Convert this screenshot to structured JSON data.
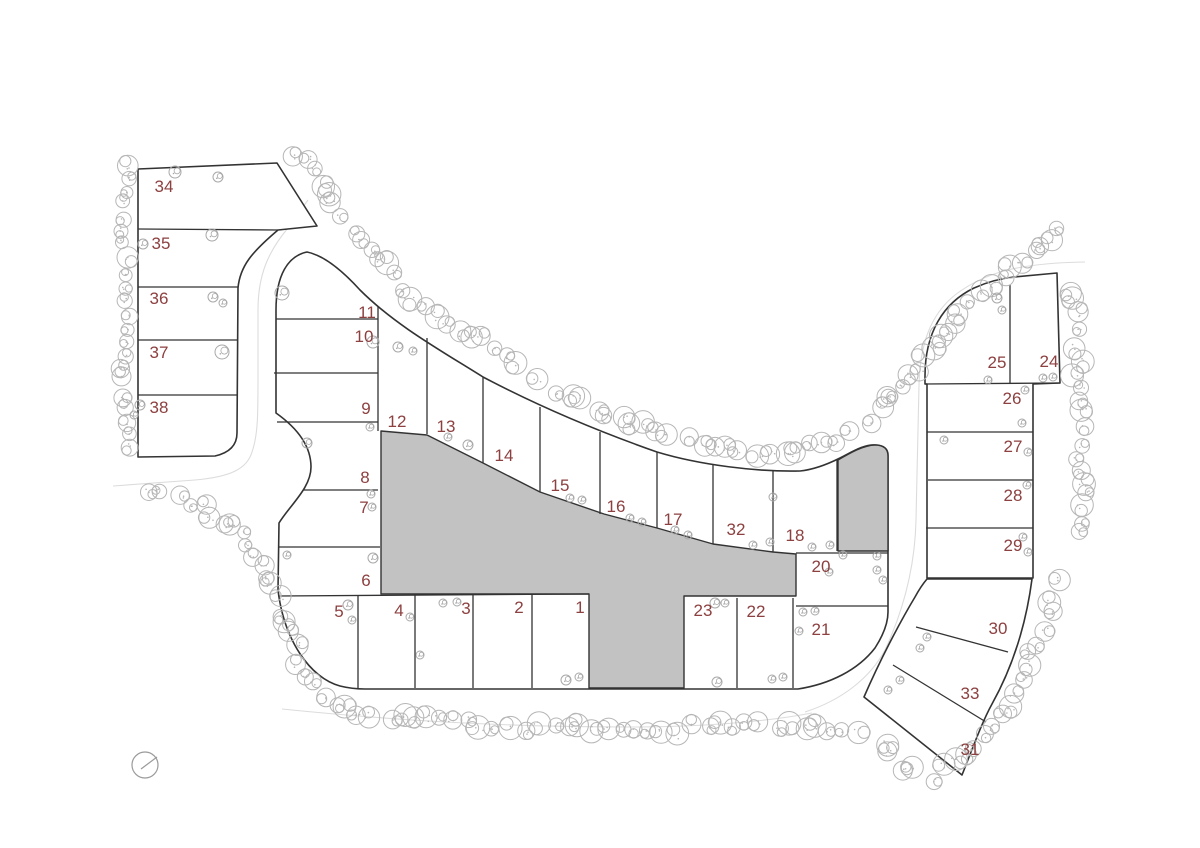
{
  "plan": {
    "title": "residential-subdivision-site-plan",
    "colors": {
      "lot_number": "#8d4040",
      "line": "#333333",
      "gray_parcel": "#c2c2c2",
      "tree": "#b6b6b6",
      "tree_small": "#a8a8a8",
      "faint_road": "#dcdcdc",
      "background": "#ffffff"
    },
    "lots": [
      {
        "number": "34",
        "x": 164,
        "y": 192
      },
      {
        "number": "35",
        "x": 161,
        "y": 249
      },
      {
        "number": "36",
        "x": 159,
        "y": 304
      },
      {
        "number": "37",
        "x": 159,
        "y": 358
      },
      {
        "number": "38",
        "x": 159,
        "y": 413
      },
      {
        "number": "11",
        "x": 367,
        "y": 318
      },
      {
        "number": "10",
        "x": 364,
        "y": 342
      },
      {
        "number": "9",
        "x": 366,
        "y": 414
      },
      {
        "number": "12",
        "x": 397,
        "y": 427
      },
      {
        "number": "13",
        "x": 446,
        "y": 432
      },
      {
        "number": "14",
        "x": 504,
        "y": 461
      },
      {
        "number": "15",
        "x": 560,
        "y": 491
      },
      {
        "number": "16",
        "x": 616,
        "y": 512
      },
      {
        "number": "17",
        "x": 673,
        "y": 525
      },
      {
        "number": "32",
        "x": 736,
        "y": 535
      },
      {
        "number": "18",
        "x": 795,
        "y": 541
      },
      {
        "number": "20",
        "x": 821,
        "y": 572
      },
      {
        "number": "8",
        "x": 365,
        "y": 483
      },
      {
        "number": "7",
        "x": 364,
        "y": 513
      },
      {
        "number": "6",
        "x": 366,
        "y": 586
      },
      {
        "number": "5",
        "x": 339,
        "y": 617
      },
      {
        "number": "4",
        "x": 399,
        "y": 616
      },
      {
        "number": "3",
        "x": 466,
        "y": 614
      },
      {
        "number": "2",
        "x": 519,
        "y": 613
      },
      {
        "number": "1",
        "x": 580,
        "y": 613
      },
      {
        "number": "23",
        "x": 703,
        "y": 616
      },
      {
        "number": "22",
        "x": 756,
        "y": 617
      },
      {
        "number": "21",
        "x": 821,
        "y": 635
      },
      {
        "number": "25",
        "x": 997,
        "y": 368
      },
      {
        "number": "24",
        "x": 1049,
        "y": 367
      },
      {
        "number": "26",
        "x": 1012,
        "y": 404
      },
      {
        "number": "27",
        "x": 1013,
        "y": 452
      },
      {
        "number": "28",
        "x": 1013,
        "y": 501
      },
      {
        "number": "29",
        "x": 1013,
        "y": 551
      },
      {
        "number": "30",
        "x": 998,
        "y": 634
      },
      {
        "number": "33",
        "x": 970,
        "y": 699
      },
      {
        "number": "31",
        "x": 970,
        "y": 755
      }
    ],
    "compass": {
      "x": 145,
      "y": 765,
      "r": 13
    }
  }
}
